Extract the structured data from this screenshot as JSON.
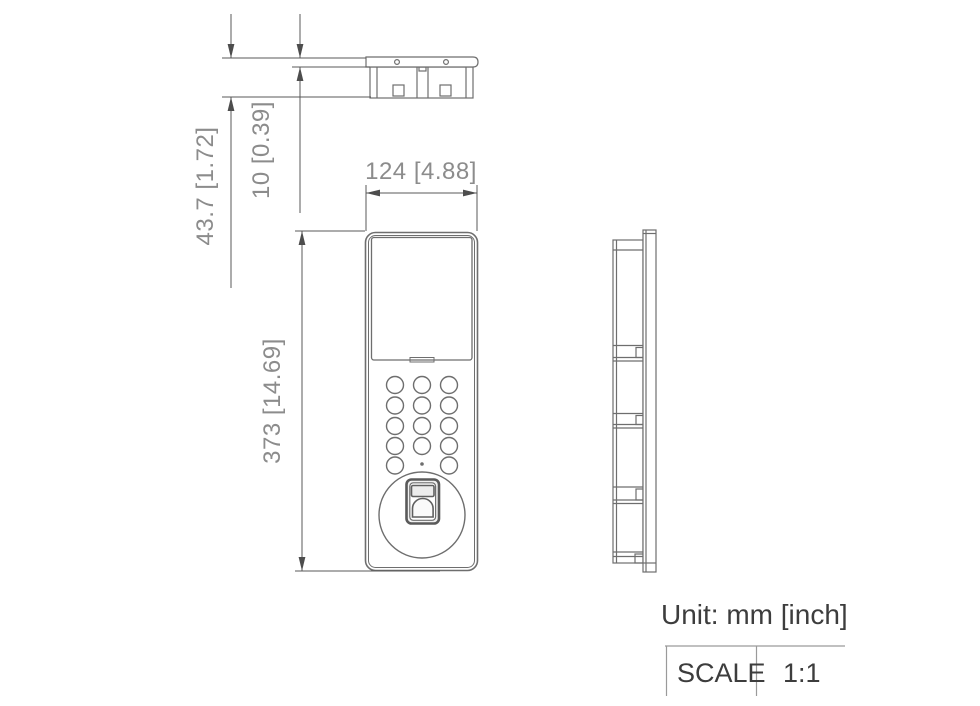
{
  "drawing": {
    "unit_note": "Unit: mm [inch]",
    "scale_table": {
      "header": "SCALE",
      "value": "1:1"
    },
    "dimensions": {
      "depth": {
        "label": "43.7 [1.72]",
        "mm": 43.7,
        "inch": 1.72
      },
      "panel_thickness": {
        "label": "10 [0.39]",
        "mm": 10,
        "inch": 0.39
      },
      "width": {
        "label": "124 [4.88]",
        "mm": 124,
        "inch": 4.88
      },
      "height": {
        "label": "373 [14.69]",
        "mm": 373,
        "inch": 14.69
      }
    },
    "colors": {
      "outline": "#6e6e6e",
      "dimension_line": "#585858",
      "arrow": "#4d4d4d",
      "dimension_text": "#8c8c8c",
      "label_text": "#3d3d3d",
      "table_line": "#9a9a9a",
      "background": "#ffffff"
    }
  }
}
